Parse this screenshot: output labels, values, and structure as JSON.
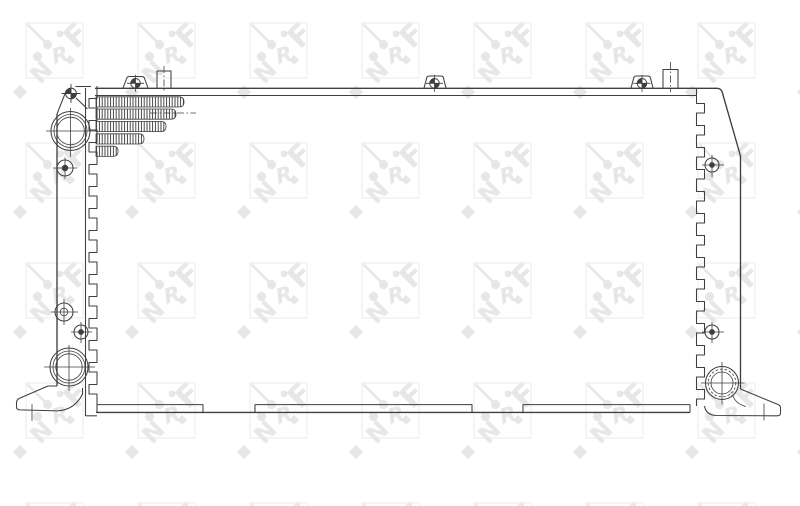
{
  "watermark": {
    "brand": "NRF",
    "letters": [
      "N",
      "R",
      "F"
    ],
    "glyph_color": "#e7e7e7",
    "square_color": "#eeeeee"
  },
  "drawing": {
    "line_color": "#3f3f3f",
    "background_color": "#ffffff"
  }
}
